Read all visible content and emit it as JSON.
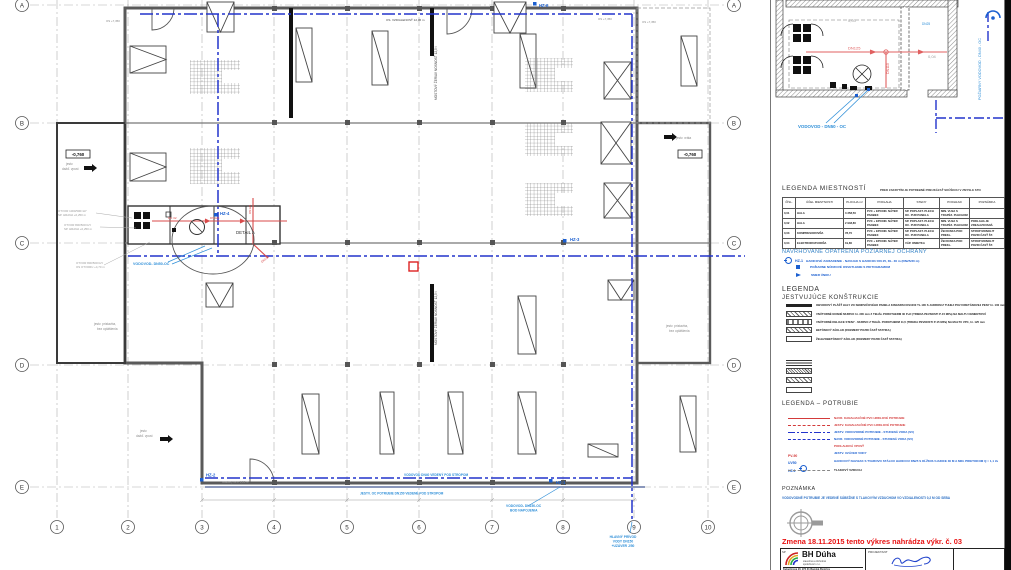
{
  "plan": {
    "grid_rows": [
      "A",
      "B",
      "C",
      "D",
      "E"
    ],
    "grid_cols": [
      "1",
      "2",
      "3",
      "4",
      "5",
      "6",
      "7",
      "8",
      "9",
      "10"
    ],
    "ann": {
      "hz1": "HZ-1",
      "hz2": "HZ-2",
      "hz3": "HZ-3",
      "hz4": "HZ-4",
      "hz6": "HZ-6",
      "dn32": "DN 32",
      "dn125": "DN125",
      "dn125b": "DN125",
      "detail_a": "DETAIL A",
      "lvl": "-0,760",
      "os735": "OS +7,350",
      "dim": "OS. VZDIALENOSŤ 12,36 m",
      "crane": "MOSTOVÝ ŽERIAV NOSNOSŤ 12,5 t",
      "vodovod50": "VODOVOD- DN50-OC",
      "vodovod40": "VODOVOD DN40 VEDENÝ POD STROPOM",
      "jestv_oc": "JESTV. OC POTRUBIE DN150 VEDENÉ POD STROPOM",
      "bod1": "VODOVOD- DN150-OC",
      "bod2": "BOD NAPOJENIA",
      "priv1": "HLAVNÝ PRÍVOD",
      "priv2": "VODY DN150",
      "priv3": "+UZÁVER J/50",
      "prist1": "jestv. prístavba,",
      "prist2": "bez opláštenia",
      "vrata": "jestv. vráta",
      "vpust1": "jestv.",
      "vpust2": "dažď. vpust",
      "hz2note": "osadený vo v. 1,20 m",
      "otv1": "OTVOR 1000/500=HY",
      "otv2": "SP. HRANA +0,250 m",
      "otv3": "OTVOR 800/500=HY",
      "otv4": "OS OTVORU +4,70 m"
    }
  },
  "detail": {
    "r3": "0,03",
    "r4": "0,04",
    "dn125": "DN125",
    "dn110": "DN110",
    "dn25": "DN25",
    "vodovod50": "VODOVOD - DN50 - OC",
    "pozvod": "POŽIARNY VODOVOD - DN40 - OC"
  },
  "legend_rooms": {
    "title": "LEGENDA MIESTNOSTÍ",
    "note": "PRED ZAKRYTÍM JE POTREBNÉ PREUKÁZAŤ SKÚŠKOU V ZMYSLE STN",
    "headers": [
      "ČÍSL.",
      "ÚČEL MIESTNOSTI",
      "PLOCHA m²",
      "PODLAHA",
      "STENY",
      "PODHĽAD",
      "POZNÁMKA"
    ],
    "rows": [
      [
        "0,01",
        "HALA",
        "3 358,50",
        "PVC + EPOXID. NÁTER PANBEX",
        "SP. POPLAST. PLECH OC. PUR PANELA",
        "MIN. VLNA S TRAPÉZ. PLECHOM",
        ""
      ],
      [
        "0,02",
        "HALA",
        "2 948,80",
        "PVC + EPOXID. NÁTER PANBEX",
        "SP. POPLAST. PLECH OC. PUR PANELA",
        "MIN. VLNA S TRAPÉZ. PLECHOM",
        "PODLAHA JE ZREALIZOVANÁ"
      ],
      [
        "0,03",
        "KOMPRESOROVŇA",
        "78,70",
        "PVC + EPOXID. NÁTER PANBEX",
        "SP. POPLAST. PLECH OC. PUR PANELA",
        "ŽB DOSKA POD PREKL.",
        "STROP MONOLIT POZRI ČASŤ ŠT."
      ],
      [
        "0,04",
        "ELEKTROROZVODŇA",
        "19,80",
        "PVC + EPOXID. NÁTER PANBEX",
        "VÁP. OMIETKA",
        "ŽB DOSKA POD PREKL.",
        "STROP MONOLIT POZRI ČASŤ ŠT."
      ]
    ]
  },
  "fire": {
    "title": "NAVRHOVANÉ OPATRENIA POŽIARNEJ OCHRANY",
    "items": [
      {
        "code": "HZ-1",
        "text": "HADICOVÉ ZARIADENIE - NAVIJAK S HADICOU DN 25, DL. 30 m (DN25/30 m)"
      },
      {
        "code": "",
        "text": "POŽIARNE NÚDZOVÉ OSVETLENIE S PIKTOGRAMOM"
      },
      {
        "code": "",
        "text": "SMER ÚNIKU"
      }
    ]
  },
  "constructions": {
    "title": "LEGENDA",
    "subtitle": "JESTVUJÚCE KONŠTRUKCIE",
    "items": [
      "OBVODOVÝ PLÁŠŤ HALY ZO SENDVIČOVÉHO PANELA KINGSPAN KS1000 TL.100 S JADROM Z TUHEJ POLYURETÁNOVEJ PENY hr. 100 mm",
      "VNÚTORNÉ NOSNÉ MURIVO hr. 300 mm Z TEHÁL POROTHERM 30 P+D (TRIEDA PEVNOSTI P-15 MPa) NA MALTU CEMENTOVÚ",
      "VNÚTORNÉ DELIACE STENY - MURIVO Z TEHÁL POROTHERM 11,5 (TRIEDA PEVNOSTI P-15 MPa) NA MALTU VPC, hr. 125 mm",
      "BETÓNOVÝ ZÁKLAD (ROZMERY POZRI ČASŤ STATIKA)",
      "ŽELEZOBETÓNOVÝ ZÁKLAD (ROZMERY POZRI ČASŤ STATIKA)"
    ]
  },
  "piping": {
    "title": "LEGENDA – POTRUBIE",
    "items": [
      {
        "code": "",
        "text": "NAVR. KANALIZAČNÉ PVC HRDLOVÉ POTRUBIE"
      },
      {
        "code": "",
        "text": "JESTV. KANALIZAČNÉ PVC HRDLOVÉ POTRUBIE"
      },
      {
        "code": "",
        "text": "JESTV. VODOVODNÉ POTRUBIE - STUDENÁ VODA (SV)"
      },
      {
        "code": "",
        "text": "NAVR. VODOVODNÉ POTRUBIE - STUDENÁ VODA (SV)"
      },
      {
        "code": "PV-90",
        "text": "PODLAHOVÁ VPUSŤ"
      },
      {
        "code": "UV50",
        "text": "JESTV. UZÁVER VODY"
      },
      {
        "code": "HZ-1",
        "text": "HADICOVÝ NAVIJAK S TVAROVO STÁLOU HADICOU DN25 S DĹŽKOU HADICE 30 M A MIN. PRIETOKOM Q = 1,1 l/s"
      },
      {
        "code": "",
        "text": "TLAKOVÝ VZDUCH"
      }
    ]
  },
  "note": {
    "title": "POZNÁMKA",
    "text": "VODOVODNÉ POTRUBIE JE VEDENÉ SÚBEŽNE S TLAKOVÝM VZDUCHOM VO VZDIALENOSTI 0,2 M OD SEBA"
  },
  "change_note": "Zmena 18.11.2015 tento výkres nahrádza výkr. č. 03",
  "titleblock": {
    "corner": "SP",
    "company": "BH Dúha",
    "sub1": "stavebná a obchodná",
    "sub2": "spoločnosť s r.o.",
    "address": "Kukučínova 20, 974 01 Banská Bystrica",
    "projektant": "PROJEKTANT"
  }
}
